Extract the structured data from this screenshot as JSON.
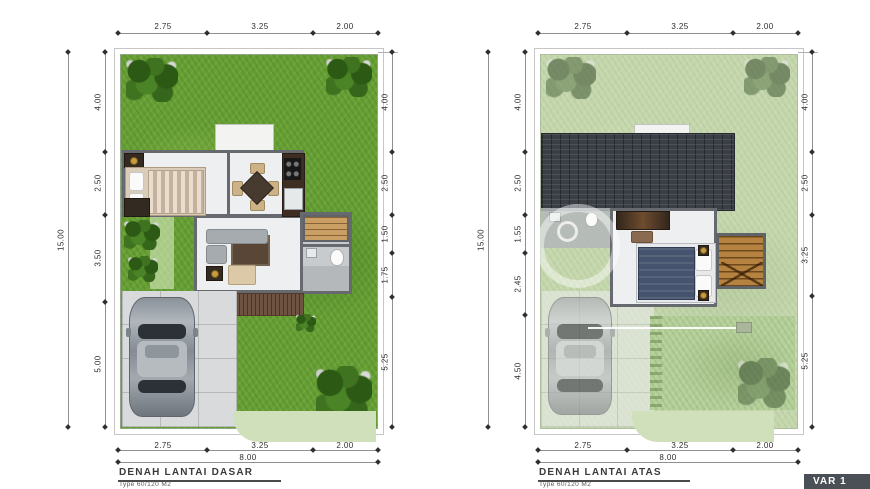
{
  "sheet": {
    "type": "architectural floor plan",
    "background": "#ffffff"
  },
  "plans": [
    {
      "title": "DENAH LANTAI DASAR",
      "subtitle": "Type 60/120 M2",
      "dims": {
        "top": [
          "2.75",
          "3.25",
          "2.00"
        ],
        "bottom": [
          "2.75",
          "3.25",
          "2.00"
        ],
        "bottom_total": "8.00",
        "left_total": "15.00",
        "left": [
          "4.00",
          "2.50",
          "3.50",
          "5.00"
        ],
        "right": [
          "4.00",
          "2.50",
          "1.50",
          "1.75",
          "5.25"
        ]
      }
    },
    {
      "title": "DENAH LANTAI ATAS",
      "subtitle": "Type 60/120 M2",
      "dims": {
        "top": [
          "2.75",
          "3.25",
          "2.00"
        ],
        "bottom": [
          "2.75",
          "3.25",
          "2.00"
        ],
        "bottom_total": "8.00",
        "left_total": "15.00",
        "left": [
          "4.00",
          "2.50",
          "1.55",
          "2.45",
          "4.50"
        ],
        "right": [
          "4.00",
          "2.50",
          "3.25",
          "5.25"
        ]
      }
    }
  ],
  "badge": {
    "label": "VAR 1",
    "bg": "#4b5056",
    "fg": "#ffffff"
  },
  "colors": {
    "grass_bright": "#67a033",
    "grass_pale": "#c5d7ad",
    "roof_tiles": "#3a3e45",
    "walls": "#66696d",
    "floor": "#edeff0",
    "wood_deck": "#6e5242",
    "wood_stairs": "#b5823f",
    "accent_gold": "#c79b3f"
  }
}
